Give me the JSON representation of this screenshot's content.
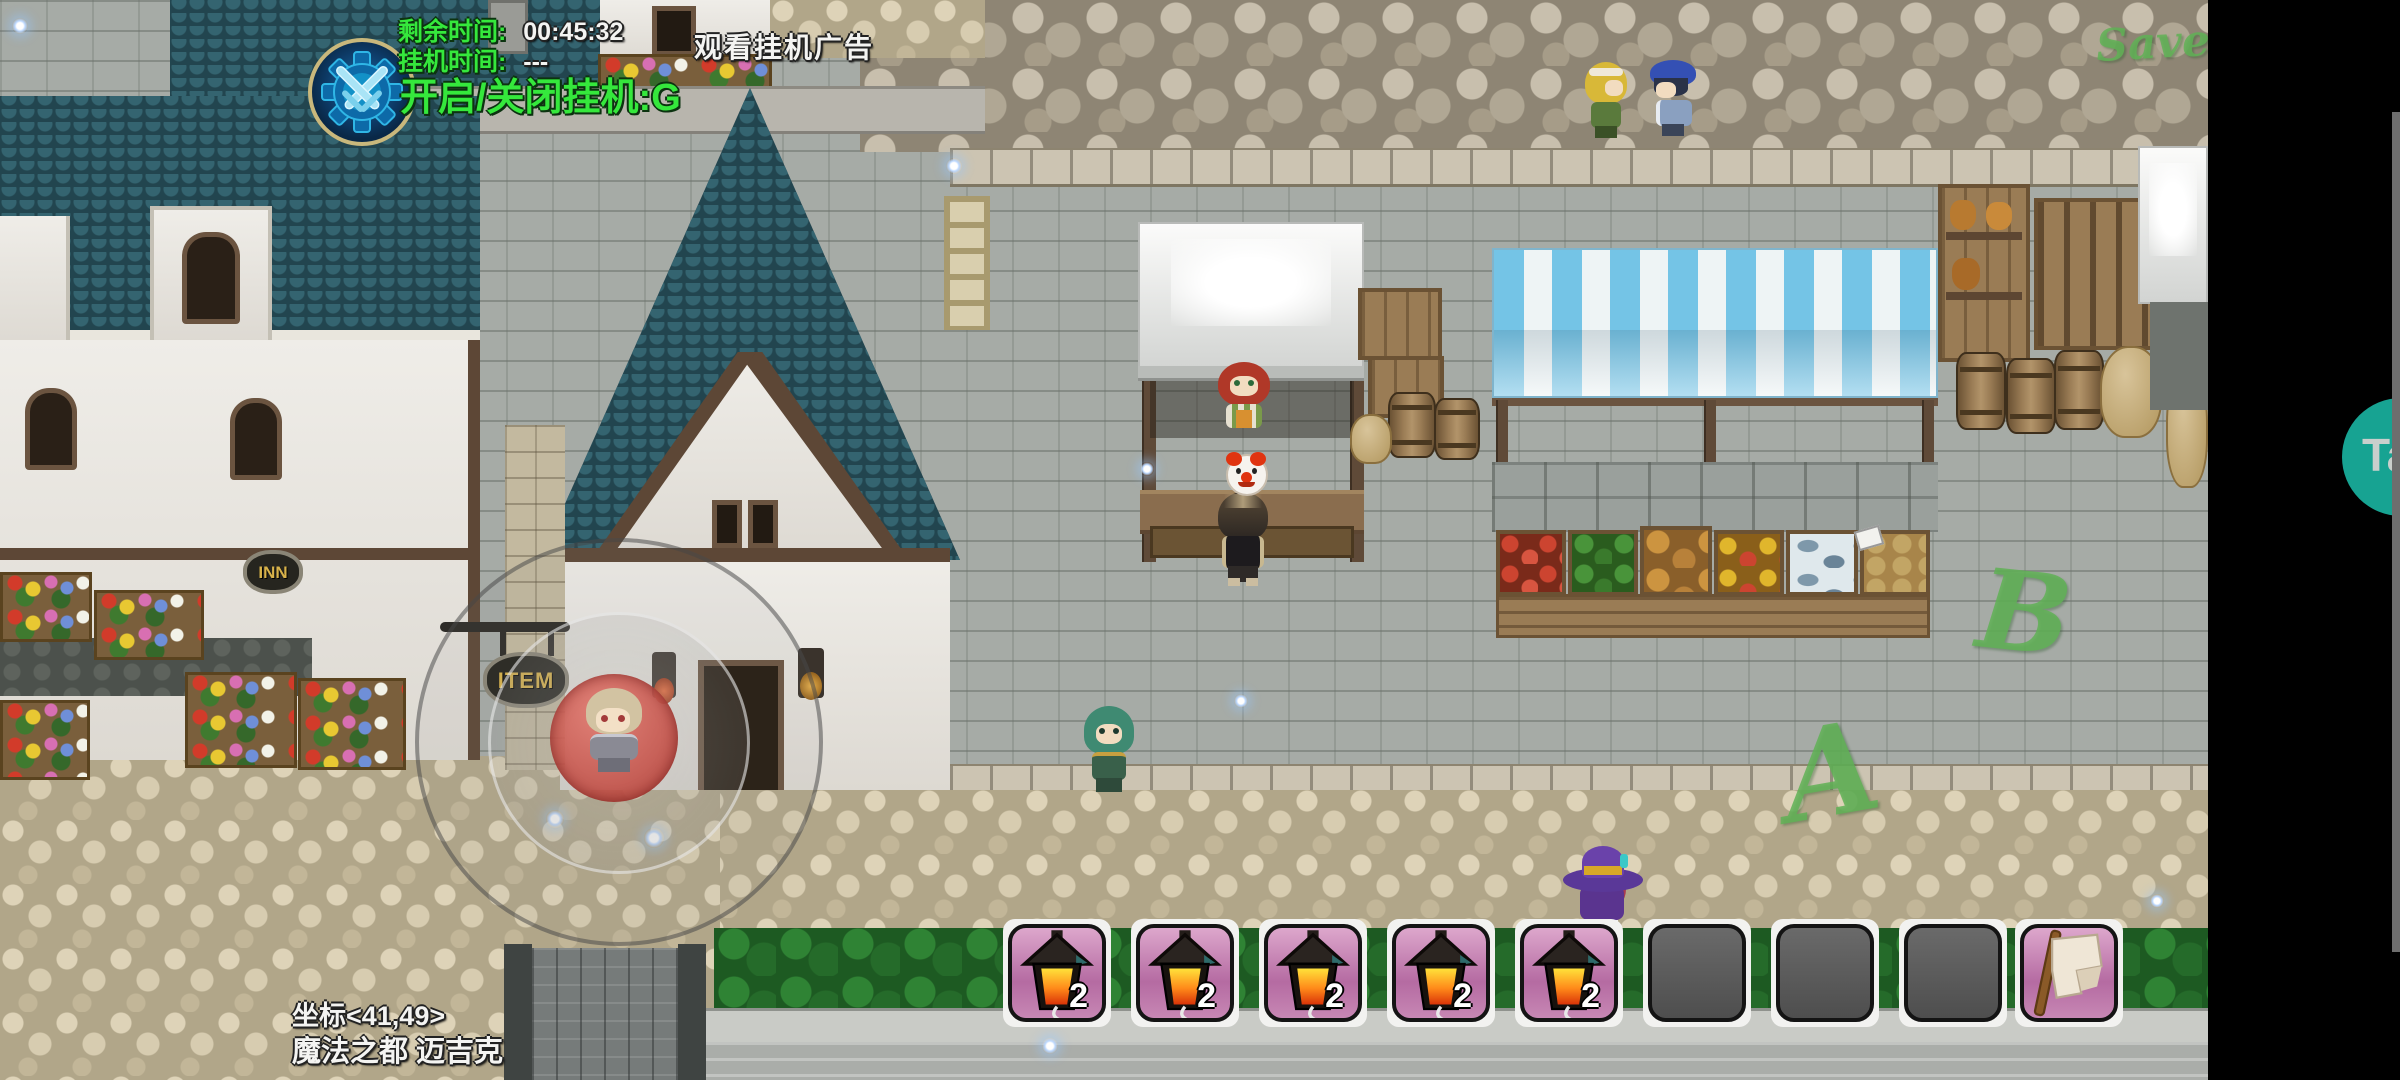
{
  "hud": {
    "afk_panel": {
      "remaining_label": "剩余时间:",
      "remaining_value": "00:45:32",
      "afk_time_label": "挂机时间:",
      "afk_time_value": "---",
      "toggle_hint": "开启/关闭挂机:G"
    },
    "watch_ad_label": "观看挂机广告",
    "location": {
      "coordinates": "坐标<41,49>",
      "map_name": "魔法之都 迈吉克"
    }
  },
  "hotbar": {
    "slots": [
      {
        "item": "lantern",
        "count": "2"
      },
      {
        "item": "lantern",
        "count": "2"
      },
      {
        "item": "lantern",
        "count": "2"
      },
      {
        "item": "lantern",
        "count": "2"
      },
      {
        "item": "lantern",
        "count": "2"
      },
      {
        "item": "",
        "count": ""
      },
      {
        "item": "",
        "count": ""
      },
      {
        "item": "",
        "count": ""
      },
      {
        "item": "scroll",
        "count": ""
      }
    ]
  },
  "world": {
    "signs": {
      "inn": "INN",
      "item": "ITEM"
    },
    "graffiti": {
      "wall": "Save",
      "ground_a": "A",
      "ground_b": "B"
    }
  },
  "floating_button": {
    "label": "Ta"
  },
  "colors": {
    "hud_green": "#35e83c",
    "slot_pink": "#cf8fbe",
    "slot_gray": "#5d5d5d",
    "teal_button": "#17a392",
    "knob_red": "#c8514a",
    "roof_teal": "#2a525d"
  }
}
